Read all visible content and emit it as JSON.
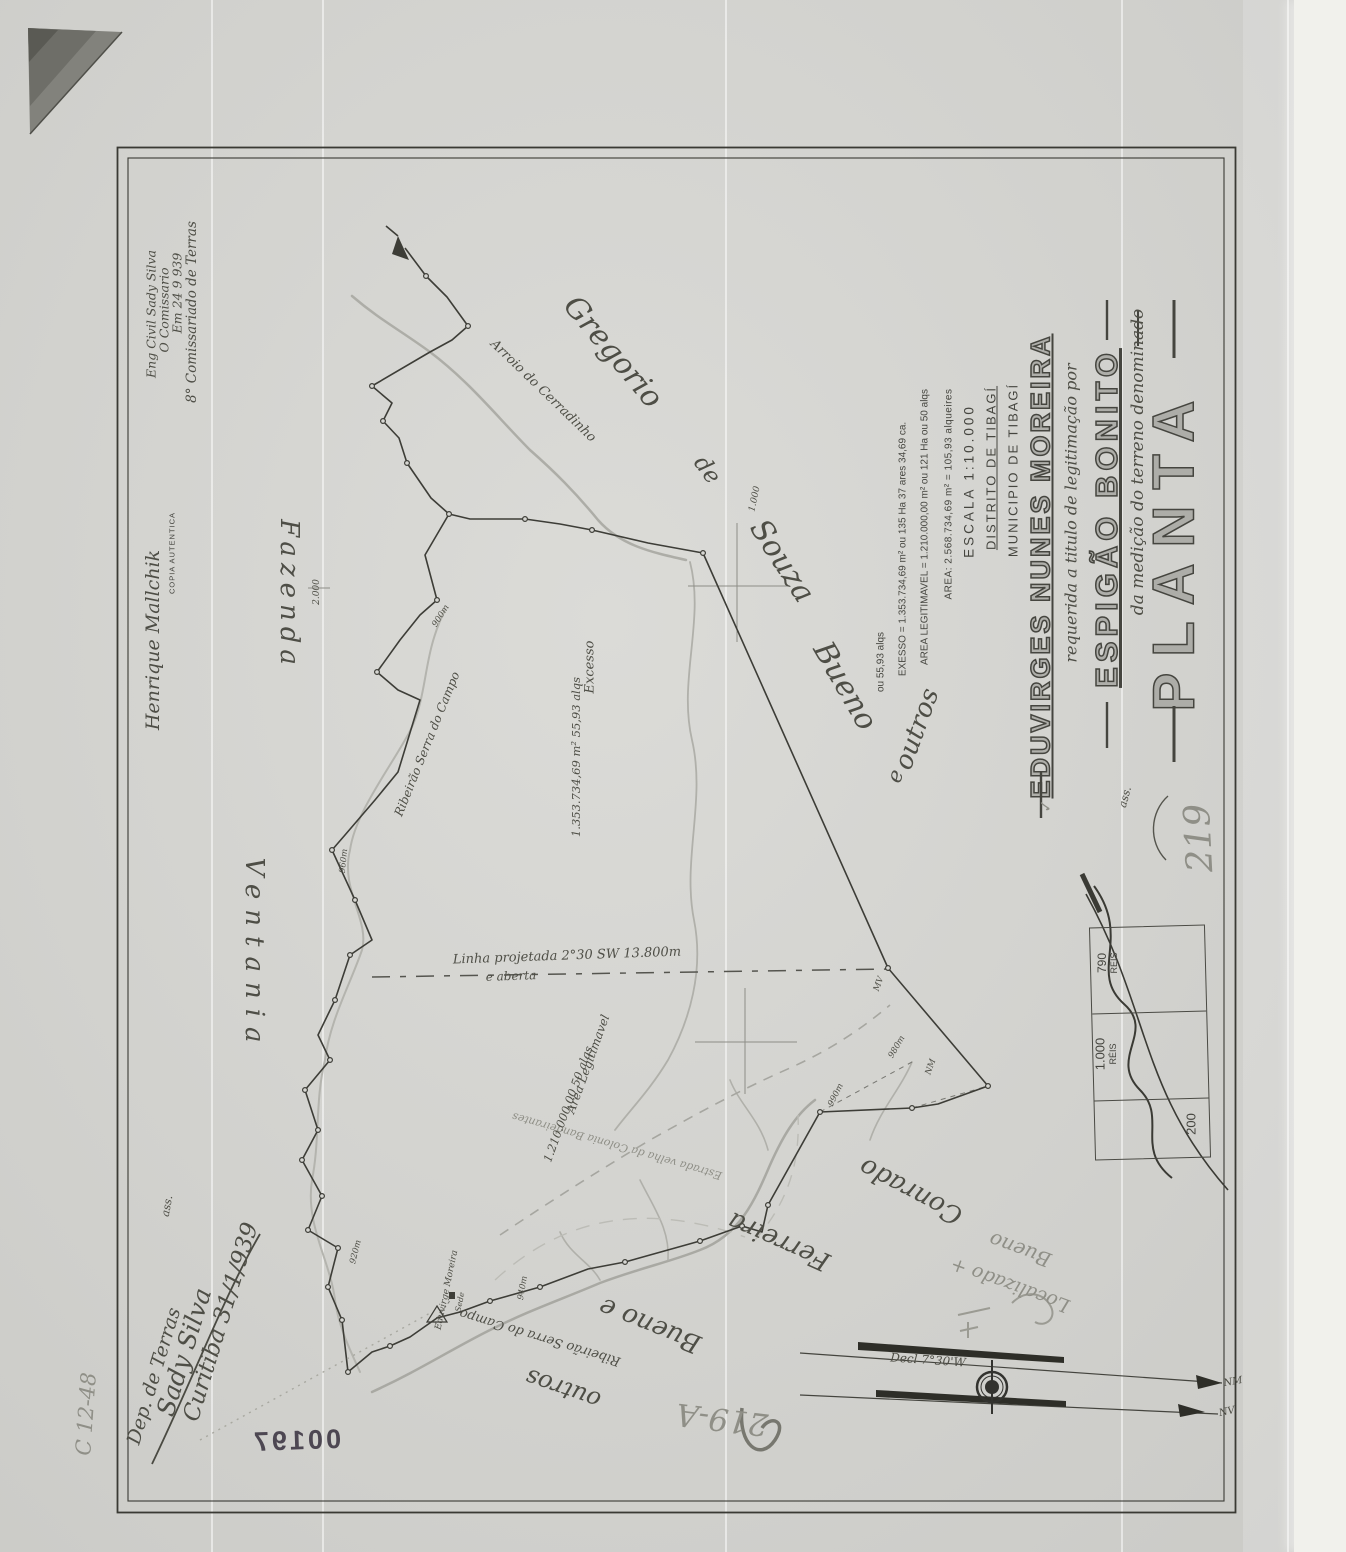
{
  "colors": {
    "ink": "#45453f",
    "pencil": "#8f8f87",
    "paper": "#d7d7d3",
    "stamp_ink": "#4d4752"
  },
  "title_block": {
    "title": "PLANTA",
    "subtitle": "da medição do terreno denominado",
    "property_name": "ESPIGÃO BONITO",
    "request_line": "requerida a titulo de legitimação por",
    "owner": "EDUVIRGES NUNES MOREIRA",
    "municipality": "MUNICIPIO DE TIBAGÍ",
    "district": "DISTRITO DE TIBAGÍ",
    "scale": "ESCALA 1:10.000",
    "area_line": "AREA: 2.568.734,69 m² = 105,93 alqueires",
    "legitimable_line": "AREA LEGITIMAVEL = 1.210.000,00 m² ou 121 Ha ou 50 alqs",
    "excess_line": "EXESSO = 1.353.734,69 m² ou 135 Ha 37 ares 34,69 ca.",
    "excess_line2": "ou 55,93 alqs",
    "ass_abbrev": "ass.",
    "check_mark": "✓"
  },
  "commission_note": {
    "line1": "8° Comissariado de Terras",
    "line2": "Em 24 9 939",
    "line3": "O Comissario",
    "line4": "Eng Civil Sady Silva"
  },
  "copy_note": {
    "label": "COPIA AUTENTICA",
    "signature": "Henrique Mallchik"
  },
  "signature_block": {
    "ass_abbrev": "ass.",
    "place_date": "Curitiba 31/1/939",
    "signature": "Sady Silva",
    "office": "Dep. de Terras"
  },
  "stamp_box": {
    "cell1_value": "790",
    "cell1_unit": "RÉIS",
    "cell2_value": "1.000",
    "cell2_unit": "RÉIS",
    "cell3_value": "200"
  },
  "archive_marks": {
    "doc_number": "219",
    "doc_number_alt": "219-A",
    "stamp_number": "00197",
    "file_code": "C 12-48",
    "pencil_note_line1": "Bueno",
    "pencil_note_line2": "Localizado +"
  },
  "neighbors": {
    "north_words": [
      "Gregorio",
      "de",
      "Souza",
      "Bueno",
      "e",
      "outros"
    ],
    "south_words": [
      "Conrado",
      "Ferreira",
      "Bueno e",
      "outros"
    ],
    "west_words": [
      "Fazenda",
      "Ventania"
    ]
  },
  "streams": {
    "cerradinho": "Arroio do Cerradinho",
    "serra_do_campo": "Ribeirão Serra do Campo",
    "old_road": "Estrada velha da Colonia Bandeirantes"
  },
  "map_notes": {
    "projected_line": "Linha projetada 2°30 SW 13.800m",
    "projected_line2": "e aberta",
    "excess_label": "Excesso",
    "excess_value": "1.353.734,69 m²  55,93 alqs",
    "legit_label": "Area Legitimavel",
    "legit_value": "1.210.000,00  50 alqs",
    "homestead": "Eduvirge Moreira",
    "homestead2": "Sede"
  },
  "grid_labels": [
    "2.000",
    "1.000"
  ],
  "distance_labels": [
    "940m",
    "920m",
    "900m",
    "960m",
    "980m",
    "990m"
  ],
  "vertex_labels": [
    "MV",
    "NM"
  ],
  "compass": {
    "declination": "Decl 7°30'W",
    "magnetic_north": "NM",
    "true_north": "NV"
  }
}
